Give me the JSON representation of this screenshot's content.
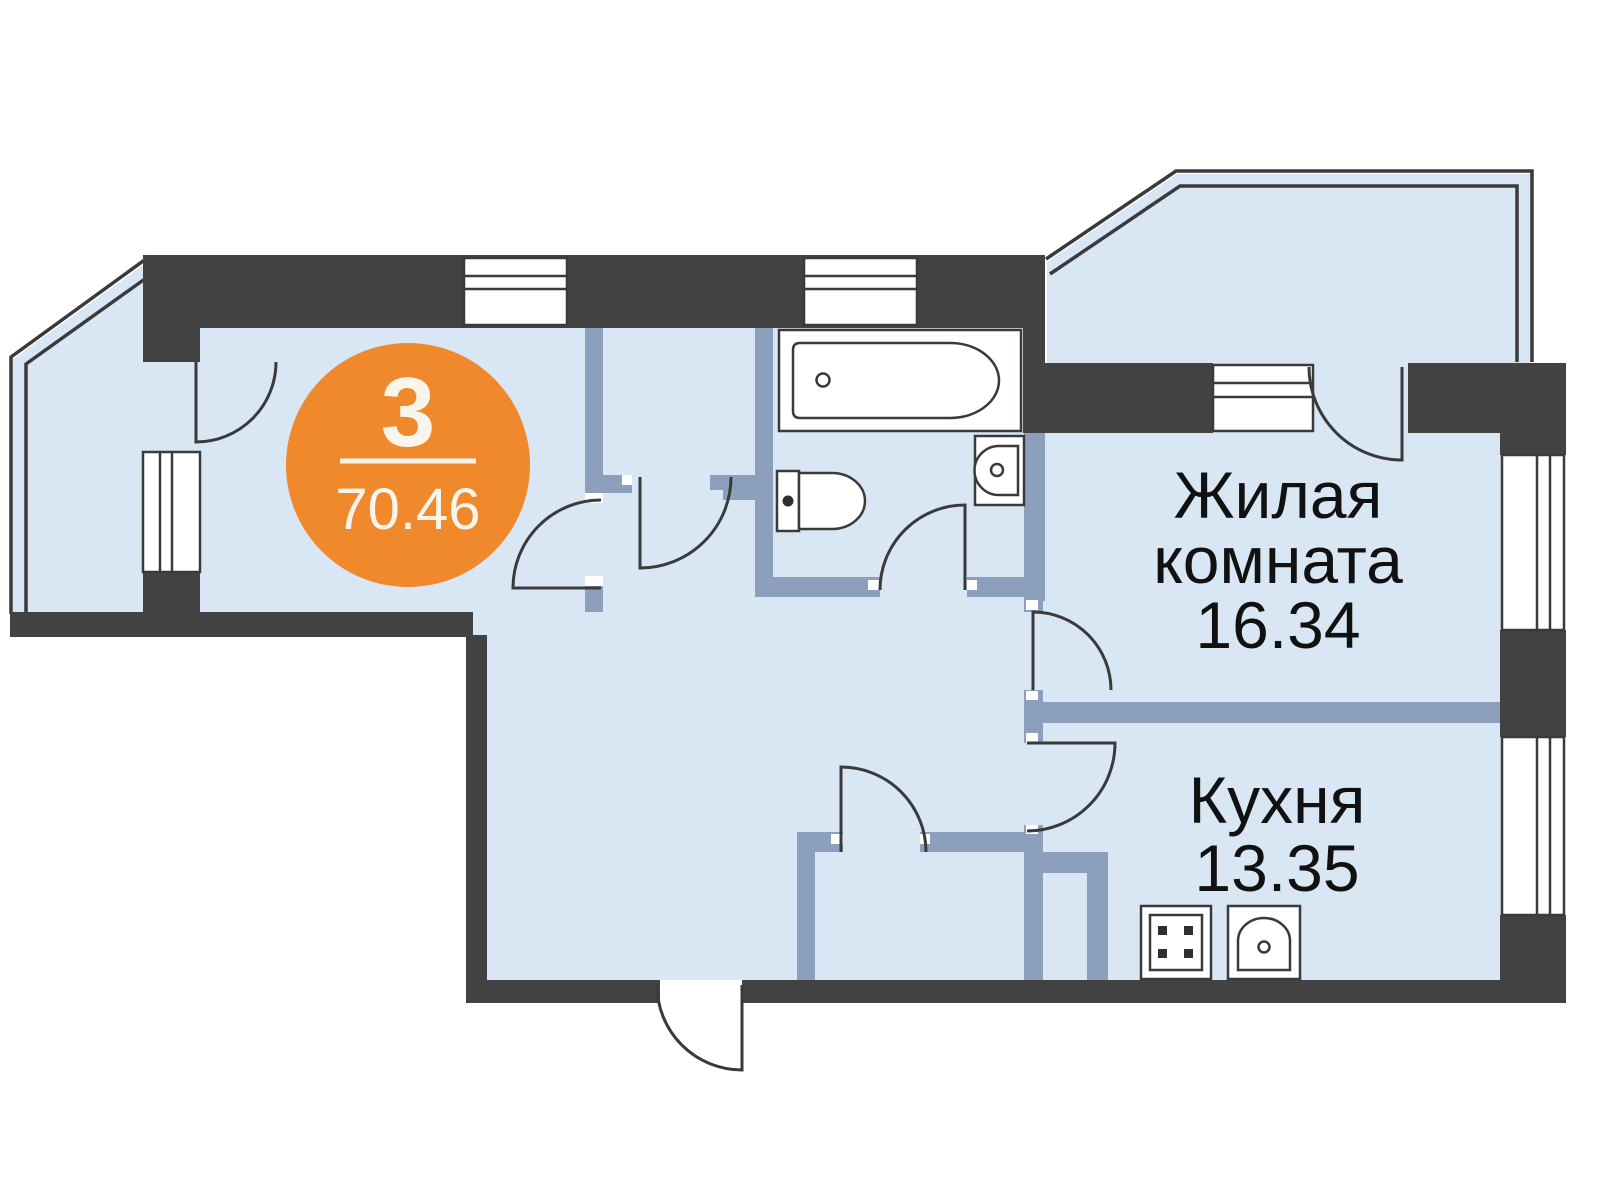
{
  "plan": {
    "badge": {
      "rooms_count": "3",
      "total_area": "70.46"
    },
    "rooms": {
      "living": {
        "name_line1": "Жилая",
        "name_line2": "комната",
        "area": "16.34"
      },
      "kitchen": {
        "name": "Кухня",
        "area": "13.35"
      }
    }
  },
  "fixtures": [
    "bathtub-icon",
    "toilet-icon",
    "washbasin-icon",
    "stove-icon",
    "kitchen-sink-icon"
  ],
  "colors": {
    "accent_orange": "#F0892C",
    "wall_dark": "#424242",
    "wall_interior": "#8CA0BE",
    "floor_fill": "#D9E7F4",
    "outline": "#3A3A3A",
    "badge_text": "#FAF5EC",
    "label_text": "#111111",
    "background": "#FFFFFF"
  }
}
